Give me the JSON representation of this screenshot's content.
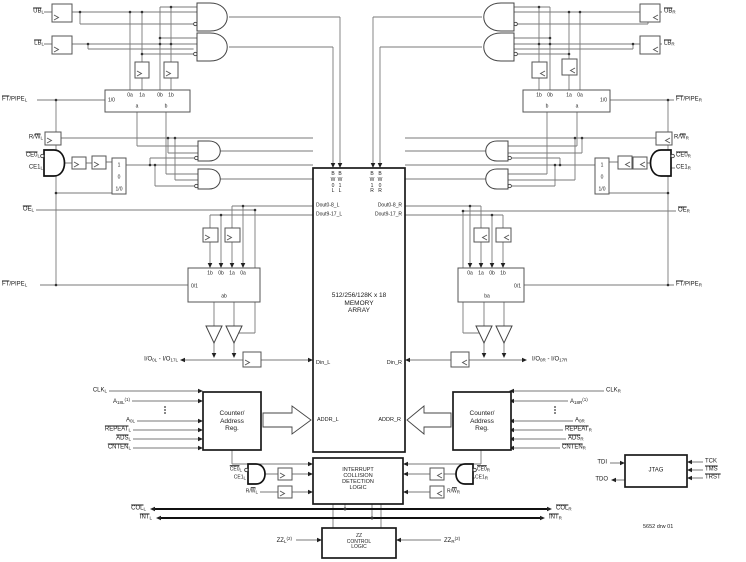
{
  "note": "5652 drw 01",
  "sig": {
    "ubl": [
      {
        "t": "UB",
        "ov": true
      },
      {
        "t": "L",
        "sub": true
      }
    ],
    "lbl": [
      {
        "t": "LB",
        "ov": true
      },
      {
        "t": "L",
        "sub": true
      }
    ],
    "ubr": [
      {
        "t": "UB",
        "ov": true
      },
      {
        "t": "R",
        "sub": true
      }
    ],
    "lbr": [
      {
        "t": "LB",
        "ov": true
      },
      {
        "t": "R",
        "sub": true
      }
    ],
    "ftpipe_l": [
      {
        "t": "FT",
        "ov": true
      },
      {
        "t": "/PIPE"
      },
      {
        "t": "L",
        "sub": true
      }
    ],
    "ftpipe_r": [
      {
        "t": "FT",
        "ov": true
      },
      {
        "t": "/PIPE"
      },
      {
        "t": "R",
        "sub": true
      }
    ],
    "rw_l": [
      {
        "t": "R/"
      },
      {
        "t": "W",
        "ov": true
      },
      {
        "t": "L",
        "sub": true
      }
    ],
    "rw_r": [
      {
        "t": "R/"
      },
      {
        "t": "W",
        "ov": true
      },
      {
        "t": "R",
        "sub": true
      }
    ],
    "ce0_l": [
      {
        "t": "CE0",
        "ov": true
      },
      {
        "t": "L",
        "sub": true
      }
    ],
    "ce1_l": [
      {
        "t": "CE1"
      },
      {
        "t": "L",
        "sub": true
      }
    ],
    "ce0_r": [
      {
        "t": "CE0",
        "ov": true
      },
      {
        "t": "R",
        "sub": true
      }
    ],
    "ce1_r": [
      {
        "t": "CE1"
      },
      {
        "t": "R",
        "sub": true
      }
    ],
    "oe_l": [
      {
        "t": "OE",
        "ov": true
      },
      {
        "t": "L",
        "sub": true
      }
    ],
    "oe_r": [
      {
        "t": "OE",
        "ov": true
      },
      {
        "t": "R",
        "sub": true
      }
    ],
    "io_l": [
      {
        "t": "I/O"
      },
      {
        "t": "0L",
        "sub": true
      },
      {
        "t": " - I/O"
      },
      {
        "t": "17L",
        "sub": true
      }
    ],
    "io_r": [
      {
        "t": "I/O"
      },
      {
        "t": "0R",
        "sub": true
      },
      {
        "t": " - I/O"
      },
      {
        "t": "17R",
        "sub": true
      }
    ],
    "clk_l": [
      {
        "t": "CLK"
      },
      {
        "t": "L",
        "sub": true
      }
    ],
    "clk_r": [
      {
        "t": "CLK"
      },
      {
        "t": "R",
        "sub": true
      }
    ],
    "a18_l": [
      {
        "t": "A"
      },
      {
        "t": "18L",
        "sub": true
      },
      {
        "t": "(1)",
        "sup": true
      }
    ],
    "a18_r": [
      {
        "t": "A"
      },
      {
        "t": "18R",
        "sub": true
      },
      {
        "t": "(1)",
        "sup": true
      }
    ],
    "a0_l": [
      {
        "t": "A"
      },
      {
        "t": "0L",
        "sub": true
      }
    ],
    "a0_r": [
      {
        "t": "A"
      },
      {
        "t": "0R",
        "sub": true
      }
    ],
    "repeat_l": [
      {
        "t": "REPEAT",
        "ov": true
      },
      {
        "t": "L",
        "sub": true
      }
    ],
    "repeat_r": [
      {
        "t": "REPEAT",
        "ov": true
      },
      {
        "t": "R",
        "sub": true
      }
    ],
    "ads_l": [
      {
        "t": "ADS",
        "ov": true
      },
      {
        "t": "L",
        "sub": true
      }
    ],
    "ads_r": [
      {
        "t": "ADS",
        "ov": true
      },
      {
        "t": "R",
        "sub": true
      }
    ],
    "cnten_l": [
      {
        "t": "CNTEN",
        "ov": true
      },
      {
        "t": "L",
        "sub": true
      }
    ],
    "cnten_r": [
      {
        "t": "CNTEN",
        "ov": true
      },
      {
        "t": "R",
        "sub": true
      }
    ],
    "col_l": [
      {
        "t": "COL",
        "ov": true
      },
      {
        "t": "L",
        "sub": true
      }
    ],
    "col_r": [
      {
        "t": "COL",
        "ov": true
      },
      {
        "t": "R",
        "sub": true
      }
    ],
    "int_l": [
      {
        "t": "INT",
        "ov": true
      },
      {
        "t": "L",
        "sub": true
      }
    ],
    "int_r": [
      {
        "t": "INT",
        "ov": true
      },
      {
        "t": "R",
        "sub": true
      }
    ],
    "zz_l": [
      {
        "t": "ZZ"
      },
      {
        "t": "L",
        "sub": true
      },
      {
        "t": "(2)",
        "sup": true
      }
    ],
    "zz_r": [
      {
        "t": "ZZ"
      },
      {
        "t": "R",
        "sub": true
      },
      {
        "t": "(2)",
        "sup": true
      }
    ],
    "tdi": "TDI",
    "tdo": "TDO",
    "tck": "TCK",
    "tms": [
      {
        "t": "TMS",
        "ov": true
      }
    ],
    "trst": [
      {
        "t": "TRST",
        "ov": true
      }
    ]
  },
  "mem": {
    "title": [
      "512/256/128K x 18",
      "MEMORY",
      "ARRAY"
    ],
    "bw": [
      [
        "B",
        "W",
        "0",
        "L"
      ],
      [
        "B",
        "W",
        "1",
        "L"
      ],
      [
        "B",
        "W",
        "1",
        "R"
      ],
      [
        "B",
        "W",
        "0",
        "R"
      ]
    ],
    "dout_l1": "Dout0-8_L",
    "dout_l2": "Dout9-17_L",
    "dout_r1": "Dout0-8_R",
    "dout_r2": "Dout9-17_R",
    "din_l": "Din_L",
    "din_r": "Din_R",
    "addr_l": "ADDR_L",
    "addr_r": "ADDR_R"
  },
  "boxes": {
    "counter": [
      "Counter/",
      "Address",
      "Reg."
    ],
    "interrupt": [
      "INTERRUPT",
      "COLLISION",
      "DETECTION",
      "LOGIC"
    ],
    "zz": [
      "ZZ",
      "CONTROL",
      "LOGIC"
    ],
    "jtag": "JTAG"
  },
  "mux": {
    "m1": {
      "sel": "1/0",
      "in": [
        "0a",
        "1a",
        "0b",
        "1b"
      ],
      "out": [
        "a",
        "b"
      ]
    },
    "m2": {
      "sel": "0/1",
      "in": [
        "1b",
        "0b",
        "1a",
        "0a"
      ],
      "out": "ab"
    },
    "m3": {
      "sel": "1/0",
      "in": [
        "1b",
        "0b",
        "1a",
        "0a"
      ],
      "out": [
        "b",
        "a"
      ]
    },
    "m4": {
      "sel": "0/1",
      "in": [
        "0a",
        "1a",
        "0b",
        "1b"
      ],
      "out": "ba"
    },
    "ms": [
      "1",
      "0",
      "1/0"
    ]
  }
}
